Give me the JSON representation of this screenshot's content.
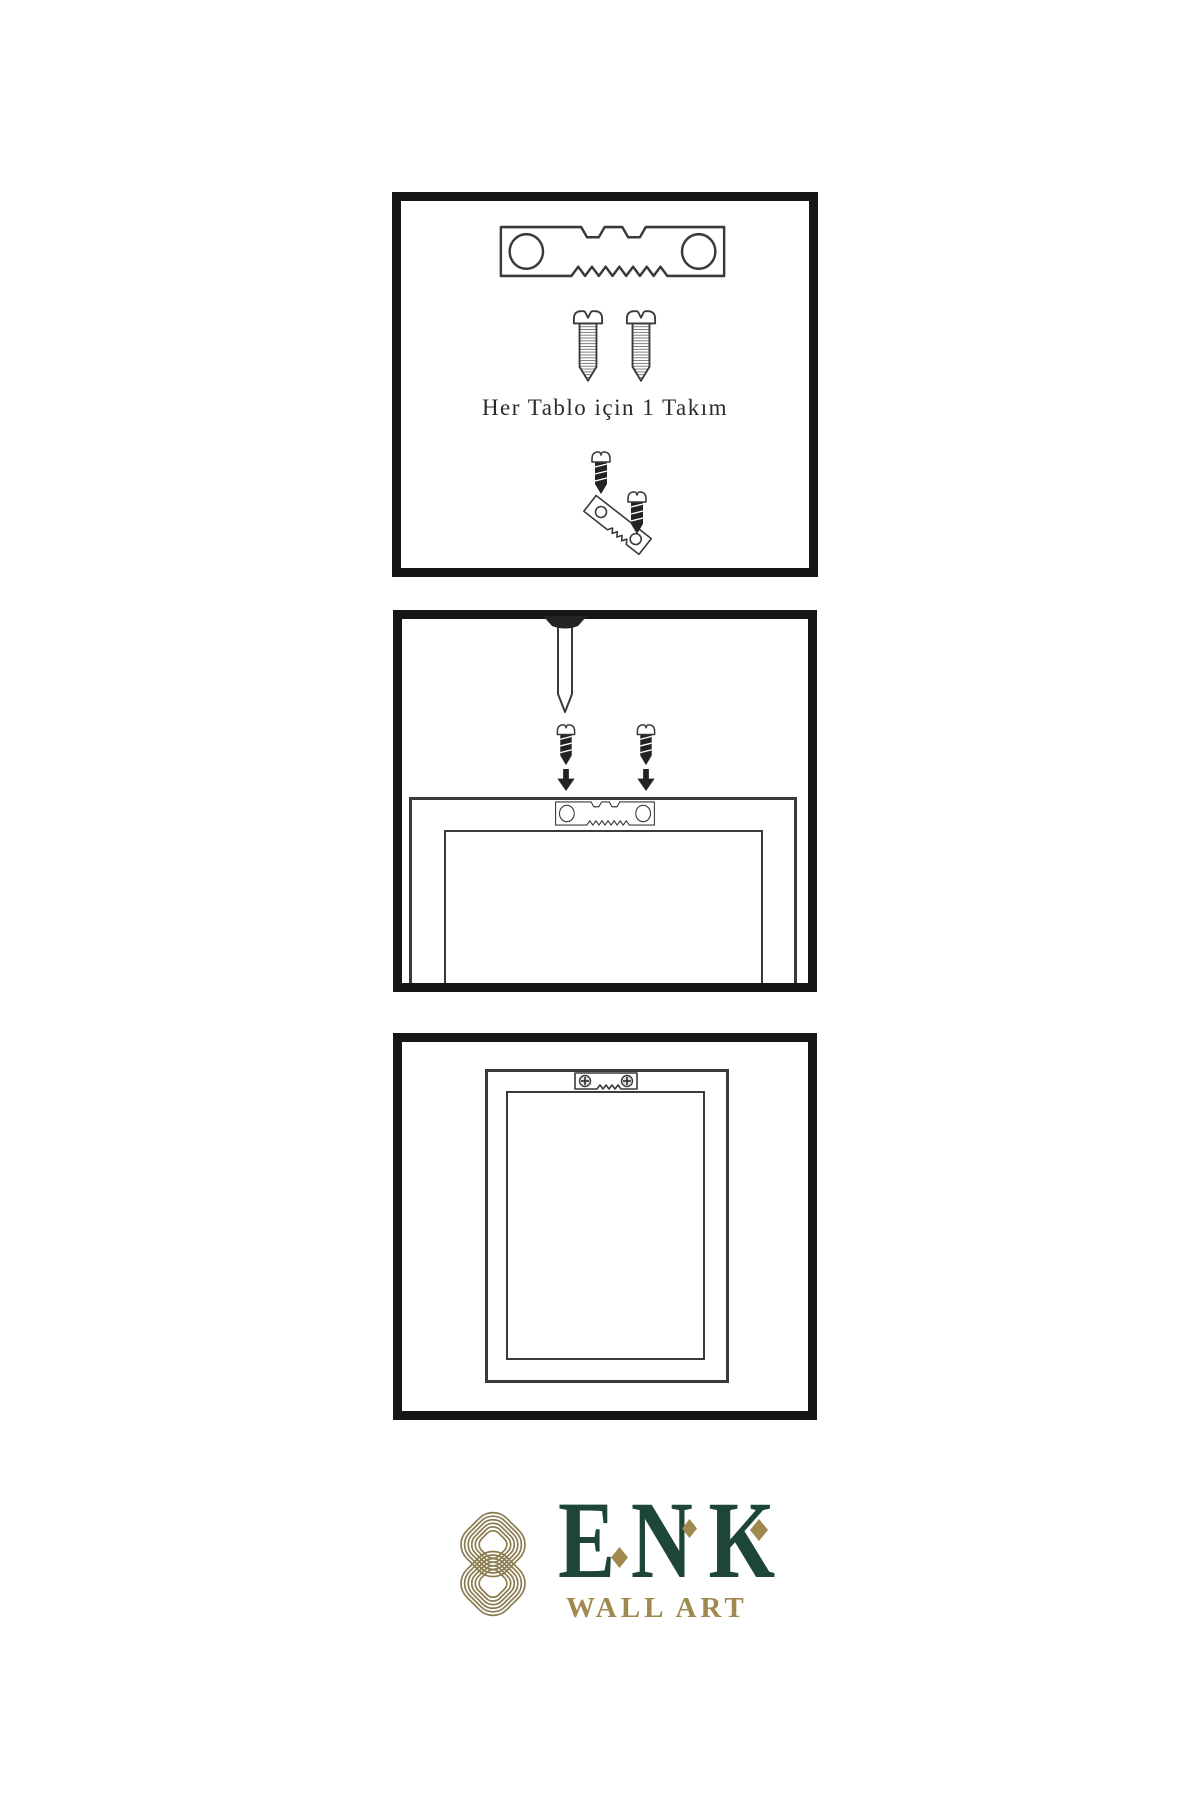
{
  "colors": {
    "page_bg": "#ffffff",
    "panel_border": "#161616",
    "line": "#3a3a3a",
    "dark_fill": "#232323",
    "logo_green": "#1d4639",
    "logo_gold": "#a0894f",
    "knot_gold": "#8a7c50"
  },
  "steps": [
    {
      "caption": "Her Tablo için 1 Takım",
      "icons": [
        "sawtooth-hanger-icon",
        "screw-icon",
        "screw-icon",
        "hanger-assembly-icon"
      ]
    },
    {
      "icons": [
        "nail-icon",
        "screw-icon",
        "screw-icon",
        "arrow-down-icon",
        "arrow-down-icon",
        "sawtooth-hanger-icon",
        "frame-back-outline"
      ]
    },
    {
      "icons": [
        "frame-back-outline",
        "sawtooth-hanger-mounted-icon"
      ]
    }
  ],
  "logo": {
    "brand": "ENK",
    "subtitle": "WALL ART",
    "mark": "interlaced-knot-icon"
  }
}
